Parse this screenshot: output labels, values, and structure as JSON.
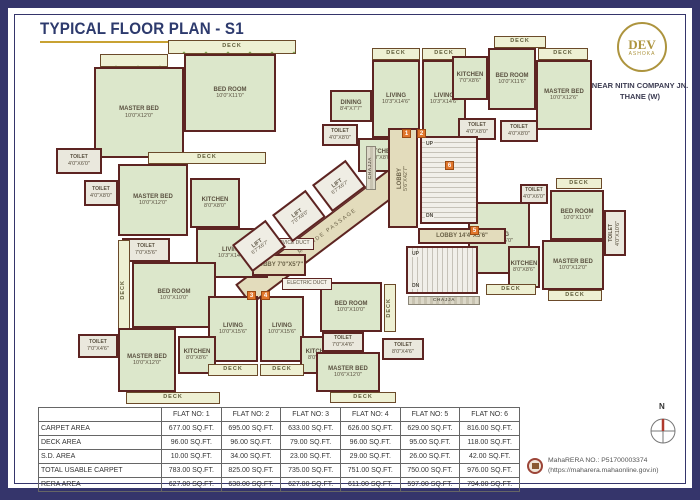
{
  "header": {
    "title": "TYPICAL FLOOR PLAN - S1"
  },
  "logo": {
    "name": "DEV",
    "sub": "ASHOKA",
    "address_line1": "NEAR NITIN COMPANY JN.",
    "address_line2": "THANE (W)"
  },
  "compass": {
    "label": "N"
  },
  "rera": {
    "line1": "MahaRERA NO.: P51700003374",
    "line2": "(https://maharera.mahaonline.gov.in)"
  },
  "area_table": {
    "headers": [
      "",
      "FLAT NO: 1",
      "FLAT NO: 2",
      "FLAT NO: 3",
      "FLAT NO: 4",
      "FLAT NO: 5",
      "FLAT NO: 6"
    ],
    "rows": [
      {
        "label": "CARPET AREA",
        "values": [
          "677.00 SQ.FT.",
          "695.00 SQ.FT.",
          "633.00 SQ.FT.",
          "626.00 SQ.FT.",
          "629.00 SQ.FT.",
          "816.00 SQ.FT."
        ]
      },
      {
        "label": "DECK AREA",
        "values": [
          "96.00 SQ.FT.",
          "96.00 SQ.FT.",
          "79.00 SQ.FT.",
          "96.00 SQ.FT.",
          "95.00 SQ.FT.",
          "118.00 SQ.FT."
        ]
      },
      {
        "label": "S.D. AREA",
        "values": [
          "10.00 SQ.FT.",
          "34.00 SQ.FT.",
          "23.00 SQ.FT.",
          "29.00 SQ.FT.",
          "26.00 SQ.FT.",
          "42.00 SQ.FT."
        ]
      },
      {
        "label": "TOTAL USABLE CARPET",
        "values": [
          "783.00 SQ.FT.",
          "825.00 SQ.FT.",
          "735.00 SQ.FT.",
          "751.00 SQ.FT.",
          "750.00 SQ.FT.",
          "976.00 SQ.FT."
        ]
      },
      {
        "label": "RERA AREA",
        "values": [
          "627.00 SQ.FT.",
          "638.00 SQ.FT.",
          "627.00 SQ.FT.",
          "611.00 SQ.FT.",
          "597.00 SQ.FT.",
          "794.00 SQ.FT."
        ]
      }
    ]
  },
  "plan": {
    "passage_label": "2.20 M. WIDE PASSAGE",
    "colors": {
      "wall": "#5d2422",
      "room": "#dce7cb",
      "deck": "#eef0d3",
      "core": "#e3dcbc",
      "frame": "#35356b",
      "gold": "#c8a233",
      "marker": "#e0762c"
    },
    "rooms": [
      {
        "type": "deck",
        "label": "DECK",
        "dims": "",
        "x": 168,
        "y": 40,
        "w": 128,
        "h": 14
      },
      {
        "type": "deck",
        "label": "",
        "dims": "",
        "x": 100,
        "y": 54,
        "w": 68,
        "h": 13
      },
      {
        "type": "room",
        "label": "BED ROOM",
        "dims": "10'0\"X11'0\"",
        "x": 184,
        "y": 54,
        "w": 92,
        "h": 78
      },
      {
        "type": "room",
        "label": "MASTER BED",
        "dims": "10'0\"X12'0\"",
        "x": 94,
        "y": 67,
        "w": 90,
        "h": 91
      },
      {
        "type": "toilet",
        "label": "TOILET",
        "dims": "4'0\"X6'0\"",
        "x": 56,
        "y": 148,
        "w": 46,
        "h": 26
      },
      {
        "type": "deck",
        "label": "DECK",
        "dims": "",
        "x": 148,
        "y": 152,
        "w": 118,
        "h": 12
      },
      {
        "type": "room",
        "label": "MASTER BED",
        "dims": "10'0\"X12'0\"",
        "x": 118,
        "y": 164,
        "w": 70,
        "h": 72
      },
      {
        "type": "toilet",
        "label": "TOILET",
        "dims": "4'0\"X8'0\"",
        "x": 84,
        "y": 180,
        "w": 34,
        "h": 26
      },
      {
        "type": "kitchen",
        "label": "KITCHEN",
        "dims": "8'0\"X8'0\"",
        "x": 190,
        "y": 178,
        "w": 50,
        "h": 50
      },
      {
        "type": "room",
        "label": "LIVING",
        "dims": "10'3\"X14'6\"",
        "x": 196,
        "y": 228,
        "w": 72,
        "h": 50
      },
      {
        "type": "toilet",
        "label": "TOILET",
        "dims": "7'0\"X5'6\"",
        "x": 122,
        "y": 238,
        "w": 48,
        "h": 24
      },
      {
        "type": "room",
        "label": "BED ROOM",
        "dims": "10'0\"X10'0\"",
        "x": 132,
        "y": 262,
        "w": 84,
        "h": 66
      },
      {
        "type": "deck",
        "label": "DECK",
        "dims": "",
        "x": 118,
        "y": 240,
        "w": 12,
        "h": 100,
        "vert": true
      },
      {
        "type": "toilet",
        "label": "TOILET",
        "dims": "7'0\"X4'6\"",
        "x": 78,
        "y": 334,
        "w": 40,
        "h": 24
      },
      {
        "type": "room",
        "label": "MASTER BED",
        "dims": "10'0\"X12'0\"",
        "x": 118,
        "y": 328,
        "w": 58,
        "h": 64
      },
      {
        "type": "deck",
        "label": "DECK",
        "dims": "",
        "x": 126,
        "y": 392,
        "w": 94,
        "h": 12
      },
      {
        "type": "room",
        "label": "LIVING",
        "dims": "10'0\"X15'6\"",
        "x": 208,
        "y": 296,
        "w": 50,
        "h": 66
      },
      {
        "type": "room",
        "label": "LIVING",
        "dims": "10'0\"X15'6\"",
        "x": 260,
        "y": 296,
        "w": 44,
        "h": 66
      },
      {
        "type": "kitchen",
        "label": "KITCHEN",
        "dims": "8'0\"X8'6\"",
        "x": 178,
        "y": 336,
        "w": 38,
        "h": 38
      },
      {
        "type": "kitchen",
        "label": "KITCHEN",
        "dims": "8'0\"X8'6\"",
        "x": 300,
        "y": 336,
        "w": 38,
        "h": 38
      },
      {
        "type": "deck",
        "label": "DECK",
        "dims": "",
        "x": 208,
        "y": 364,
        "w": 50,
        "h": 12
      },
      {
        "type": "deck",
        "label": "DECK",
        "dims": "",
        "x": 260,
        "y": 364,
        "w": 44,
        "h": 12
      },
      {
        "type": "room",
        "label": "BED ROOM",
        "dims": "10'0\"X10'0\"",
        "x": 320,
        "y": 282,
        "w": 62,
        "h": 50
      },
      {
        "type": "toilet",
        "label": "TOILET",
        "dims": "7'0\"X4'6\"",
        "x": 322,
        "y": 332,
        "w": 42,
        "h": 20
      },
      {
        "type": "room",
        "label": "MASTER BED",
        "dims": "10'6\"X12'0\"",
        "x": 316,
        "y": 352,
        "w": 64,
        "h": 40
      },
      {
        "type": "toilet",
        "label": "TOILET",
        "dims": "8'0\"X4'6\"",
        "x": 382,
        "y": 338,
        "w": 42,
        "h": 22
      },
      {
        "type": "deck",
        "label": "DECK",
        "dims": "",
        "x": 330,
        "y": 392,
        "w": 66,
        "h": 11
      },
      {
        "type": "deck",
        "label": "DECK",
        "dims": "",
        "x": 384,
        "y": 284,
        "w": 12,
        "h": 48,
        "vert": true
      },
      {
        "type": "deck",
        "label": "DECK",
        "dims": "",
        "x": 372,
        "y": 48,
        "w": 48,
        "h": 12
      },
      {
        "type": "deck",
        "label": "DECK",
        "dims": "",
        "x": 422,
        "y": 48,
        "w": 44,
        "h": 12
      },
      {
        "type": "room",
        "label": "LIVING",
        "dims": "10'3\"X14'6\"",
        "x": 372,
        "y": 60,
        "w": 48,
        "h": 78
      },
      {
        "type": "room",
        "label": "LIVING",
        "dims": "10'3\"X14'6\"",
        "x": 422,
        "y": 60,
        "w": 44,
        "h": 78
      },
      {
        "type": "room",
        "label": "DINING",
        "dims": "8'4\"X7'7\"",
        "x": 330,
        "y": 90,
        "w": 42,
        "h": 32
      },
      {
        "type": "toilet",
        "label": "TOILET",
        "dims": "4'0\"X8'0\"",
        "x": 322,
        "y": 124,
        "w": 36,
        "h": 22
      },
      {
        "type": "kitchen",
        "label": "KITCHEN",
        "dims": "7'0\"X8'0\"",
        "x": 358,
        "y": 138,
        "w": 46,
        "h": 34
      },
      {
        "type": "deck",
        "label": "DECK",
        "dims": "",
        "x": 494,
        "y": 36,
        "w": 52,
        "h": 12
      },
      {
        "type": "deck",
        "label": "DECK",
        "dims": "",
        "x": 538,
        "y": 48,
        "w": 50,
        "h": 12
      },
      {
        "type": "kitchen",
        "label": "KITCHEN",
        "dims": "7'0\"X8'6\"",
        "x": 452,
        "y": 56,
        "w": 36,
        "h": 44
      },
      {
        "type": "room",
        "label": "BED ROOM",
        "dims": "10'0\"X11'6\"",
        "x": 488,
        "y": 48,
        "w": 48,
        "h": 62
      },
      {
        "type": "room",
        "label": "MASTER BED",
        "dims": "10'0\"X12'6\"",
        "x": 536,
        "y": 60,
        "w": 56,
        "h": 70
      },
      {
        "type": "toilet",
        "label": "TOILET",
        "dims": "4'0\"X8'0\"",
        "x": 458,
        "y": 118,
        "w": 38,
        "h": 22
      },
      {
        "type": "toilet",
        "label": "TOILET",
        "dims": "4'0\"X8'0\"",
        "x": 500,
        "y": 120,
        "w": 38,
        "h": 22
      },
      {
        "type": "room",
        "label": "LIVING",
        "dims": "10'3\"X15'0\"",
        "x": 468,
        "y": 202,
        "w": 62,
        "h": 72
      },
      {
        "type": "room",
        "label": "BED ROOM",
        "dims": "10'0\"X11'0\"",
        "x": 550,
        "y": 190,
        "w": 54,
        "h": 50
      },
      {
        "type": "room",
        "label": "MASTER BED",
        "dims": "10'0\"X12'0\"",
        "x": 542,
        "y": 240,
        "w": 62,
        "h": 50
      },
      {
        "type": "kitchen",
        "label": "KITCHEN",
        "dims": "8'0\"X8'6\"",
        "x": 508,
        "y": 246,
        "w": 32,
        "h": 42
      },
      {
        "type": "toilet",
        "label": "TOILET",
        "dims": "4'0\"X6'0\"",
        "x": 520,
        "y": 184,
        "w": 28,
        "h": 20
      },
      {
        "type": "toilet",
        "label": "TOILET",
        "dims": "4'0\"X10'6\"",
        "x": 604,
        "y": 210,
        "w": 22,
        "h": 46,
        "vert": true
      },
      {
        "type": "deck",
        "label": "DECK",
        "dims": "",
        "x": 556,
        "y": 178,
        "w": 46,
        "h": 11
      },
      {
        "type": "deck",
        "label": "DECK",
        "dims": "",
        "x": 486,
        "y": 284,
        "w": 50,
        "h": 11
      },
      {
        "type": "deck",
        "label": "DECK",
        "dims": "",
        "x": 548,
        "y": 290,
        "w": 54,
        "h": 11
      },
      {
        "type": "core",
        "label": "LOBBY",
        "dims": "5'6\"X42'7\"",
        "x": 388,
        "y": 128,
        "w": 30,
        "h": 100,
        "vert": true
      },
      {
        "type": "core",
        "label": "LOBBY 14'4\"X5'6\"",
        "dims": "",
        "x": 418,
        "y": 228,
        "w": 88,
        "h": 16
      },
      {
        "type": "core",
        "label": "LOBBY 7'0\"X5'7\"",
        "dims": "",
        "x": 252,
        "y": 254,
        "w": 54,
        "h": 22
      },
      {
        "type": "duct",
        "label": "SERVICE DUCT",
        "dims": "",
        "x": 268,
        "y": 238,
        "w": 46,
        "h": 12
      },
      {
        "type": "duct",
        "label": "ELECTRIC DUCT",
        "dims": "",
        "x": 282,
        "y": 278,
        "w": 50,
        "h": 12
      },
      {
        "type": "chajja",
        "label": "CHAJJA",
        "dims": "",
        "x": 408,
        "y": 296,
        "w": 72,
        "h": 9
      },
      {
        "type": "chajja",
        "label": "CHAJJA",
        "dims": "",
        "x": 366,
        "y": 146,
        "w": 10,
        "h": 44,
        "vert": true
      }
    ],
    "lifts": [
      {
        "label": "LIFT",
        "dims": "6'7\"X6'7\"",
        "x": 238,
        "y": 229
      },
      {
        "label": "LIFT",
        "dims": "7'0\"X8'0\"",
        "x": 278,
        "y": 199
      },
      {
        "label": "LIFT",
        "dims": "6'7\"X6'7\"",
        "x": 318,
        "y": 169
      }
    ],
    "stairs": [
      {
        "x": 420,
        "y": 136,
        "w": 58,
        "h": 88,
        "dir": "v",
        "up": "UP",
        "dn": "DN"
      },
      {
        "x": 406,
        "y": 246,
        "w": 72,
        "h": 48,
        "dir": "h",
        "up": "UP",
        "dn": "DN"
      }
    ],
    "markers": [
      {
        "n": "1",
        "x": 402,
        "y": 129
      },
      {
        "n": "2",
        "x": 417,
        "y": 129
      },
      {
        "n": "3",
        "x": 247,
        "y": 291
      },
      {
        "n": "4",
        "x": 261,
        "y": 291
      },
      {
        "n": "5",
        "x": 470,
        "y": 226
      },
      {
        "n": "6",
        "x": 445,
        "y": 161
      }
    ]
  }
}
